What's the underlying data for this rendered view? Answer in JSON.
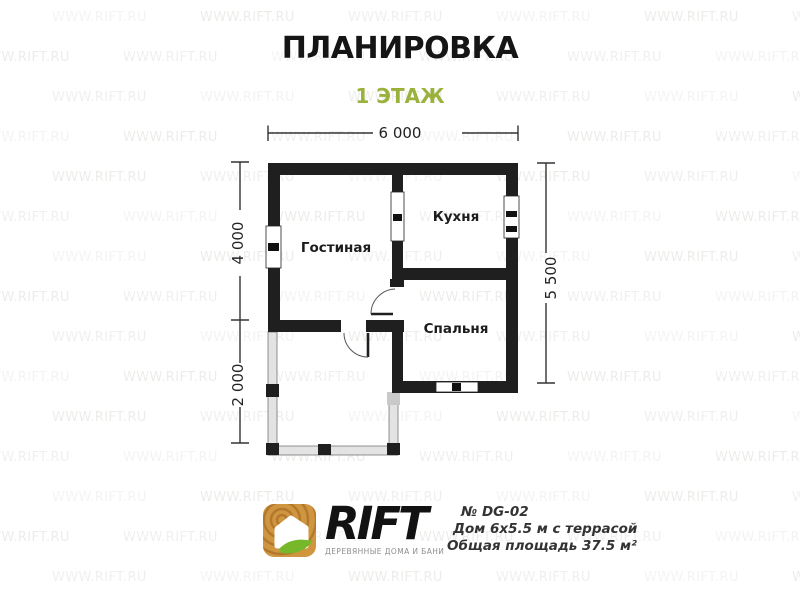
{
  "header": {
    "title": "ПЛАНИРОВКА",
    "floor_label": "1 ЭТАЖ"
  },
  "plan": {
    "rooms": [
      {
        "name": "Гостиная"
      },
      {
        "name": "Кухня"
      },
      {
        "name": "Спальня"
      }
    ],
    "dimensions": {
      "top": "6 000",
      "left_upper": "4 000",
      "left_lower": "2 000",
      "right": "5 500"
    }
  },
  "watermark": {
    "text": "WWW.RIFT.RU"
  },
  "footer": {
    "brand": "RIFT",
    "tagline": "ДЕРЕВЯННЫЕ ДОМА И БАНИ",
    "model_number": "№ DG-02",
    "house_description": "Дом 6х5.5 м с террасой",
    "total_area": "Общая площадь 37.5 м²"
  },
  "colors": {
    "accent_green": "#9ab23c",
    "wall": "#1f1f1f",
    "terrace_fill": "#e3e3e3",
    "watermark": "#a8a396",
    "logo_wood": "#d0953f",
    "logo_leaf": "#76b82a",
    "title_color": "#151515",
    "footer_text": "#333333",
    "tagline": "#8f8f8f"
  }
}
